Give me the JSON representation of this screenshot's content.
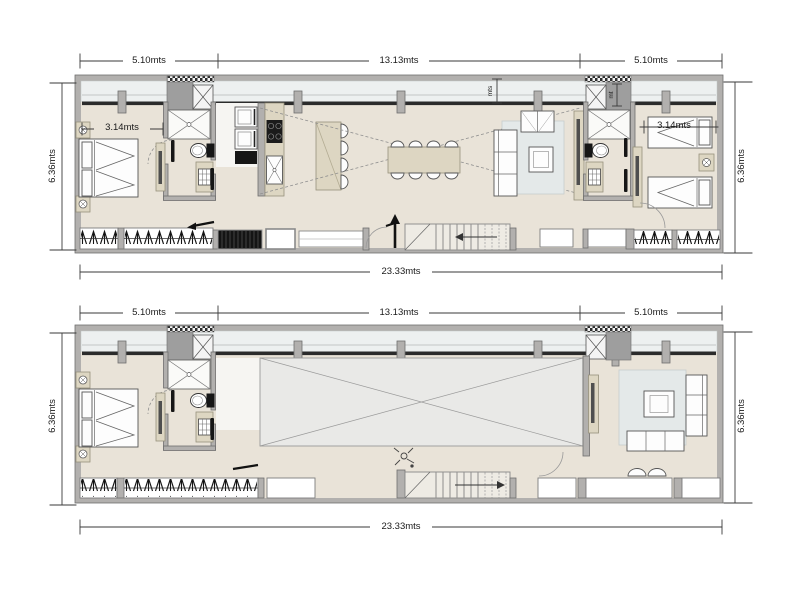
{
  "upper_plan": {
    "dims": {
      "top_left": "5.10mts",
      "top_center": "13.13mts",
      "top_right": "5.10mts",
      "side_left": "6.36mts",
      "side_right": "6.36mts",
      "bottom": "23.33mts",
      "bedroom_left": "3.14mts",
      "bedroom_right": "3.14mts",
      "balcony_depth": "mts",
      "duct_depth": "mt"
    }
  },
  "lower_plan": {
    "dims": {
      "top_left": "5.10mts",
      "top_center": "13.13mts",
      "top_right": "5.10mts",
      "side_left": "6.36mts",
      "side_right": "6.36mts",
      "bottom": "23.33mts"
    }
  },
  "colors": {
    "wall": "#b2b0ae",
    "floor": "#e9e3d8",
    "balcony": "#edf0f0",
    "tan": "#ddd6c2",
    "void": "#e9e9e7",
    "rug": "#e4e9e9",
    "dim_line": "#3a3a3a"
  }
}
